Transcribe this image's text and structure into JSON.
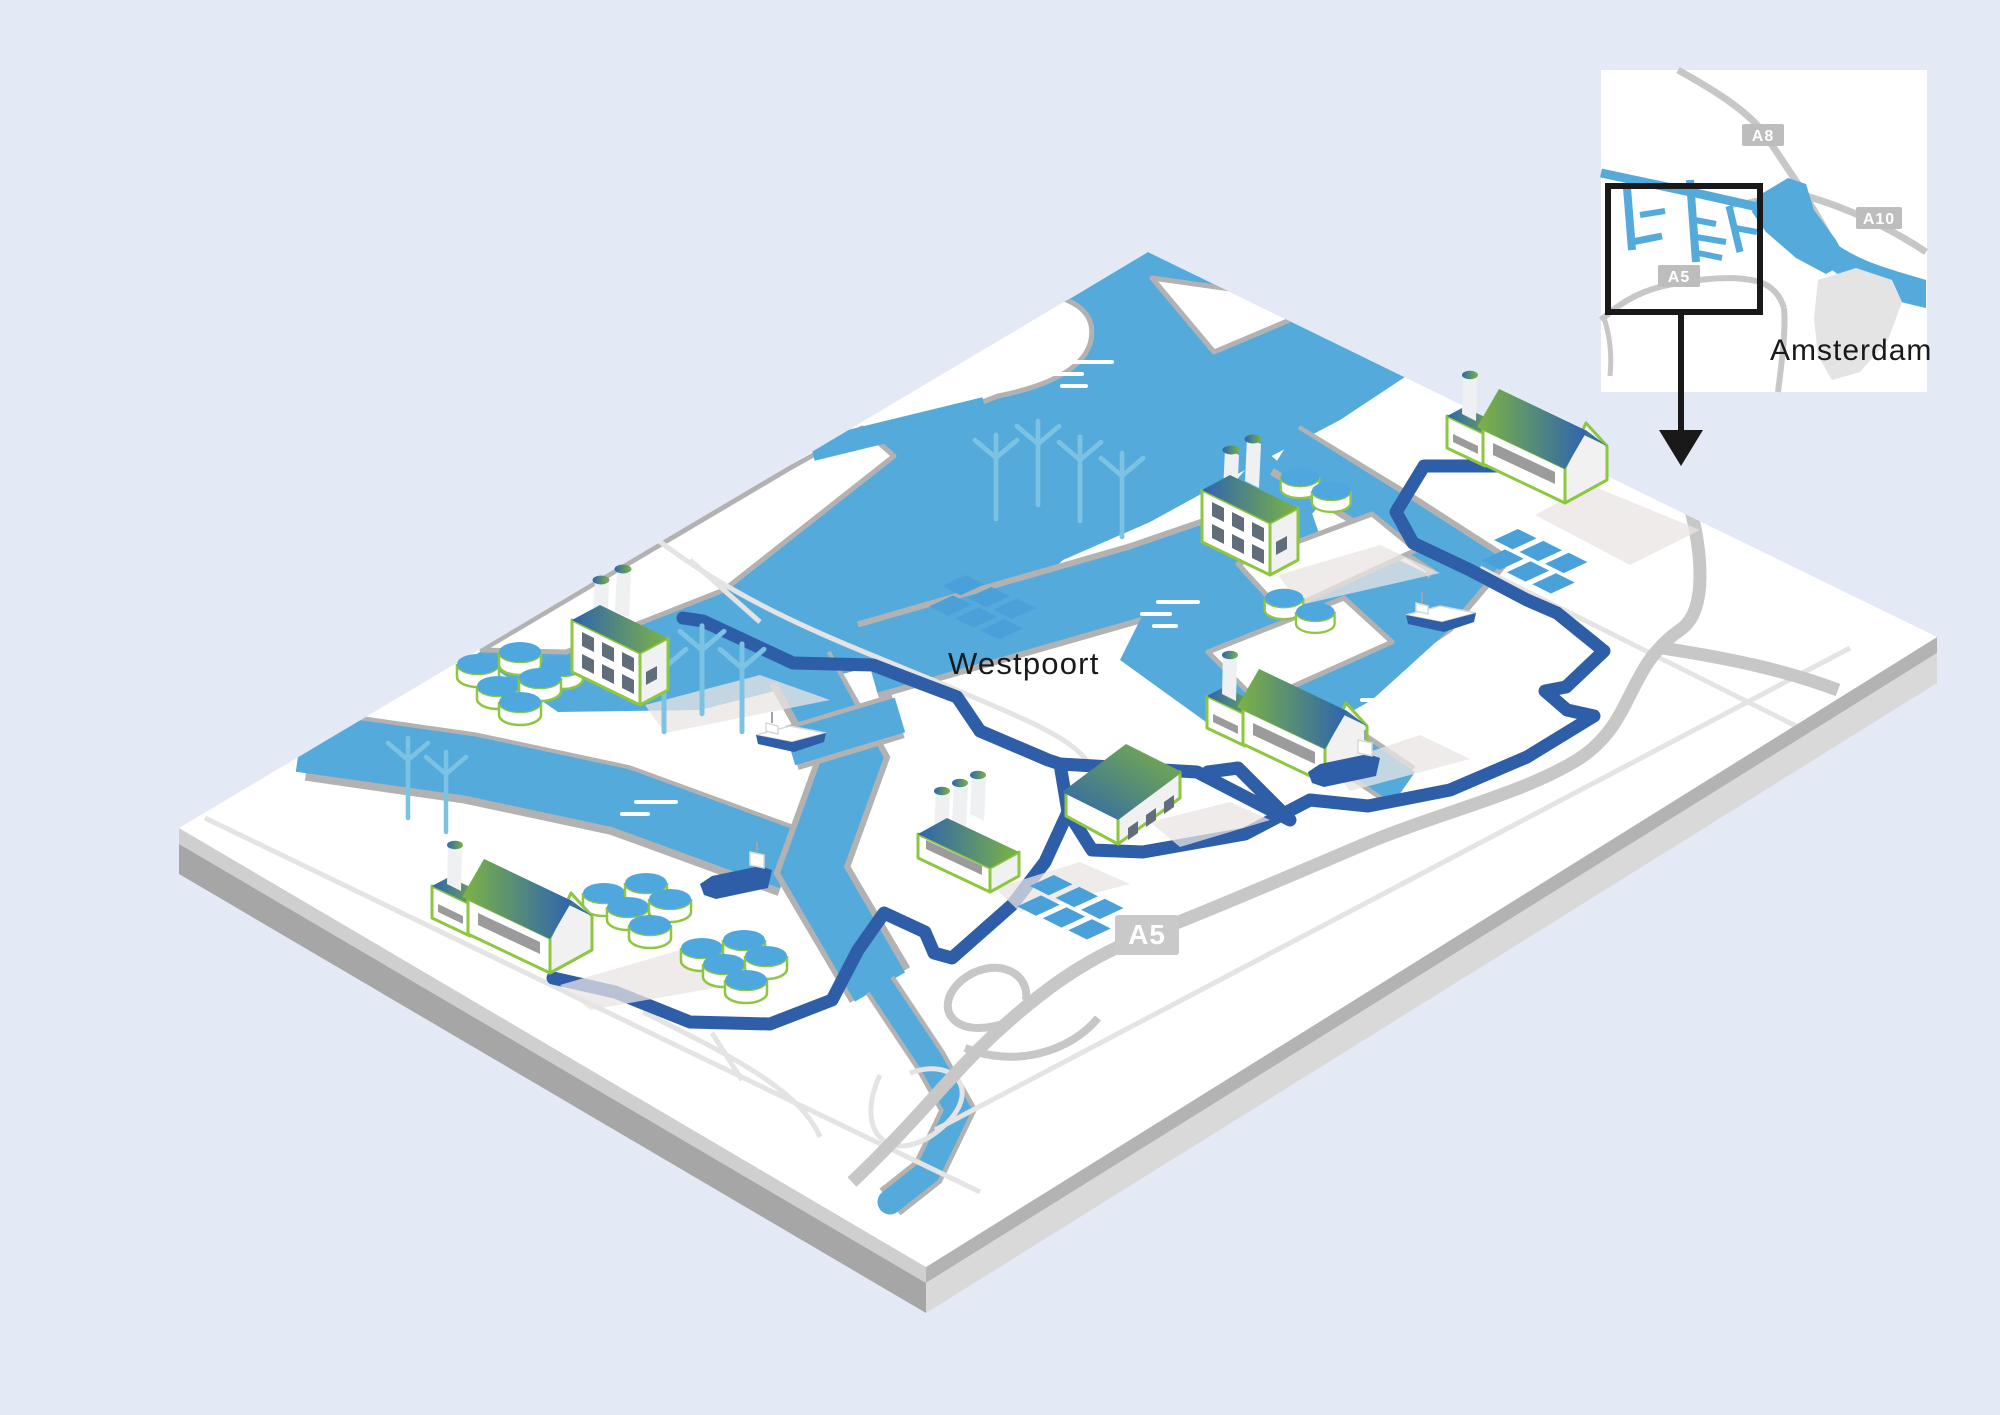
{
  "labels": {
    "area": "Westpoort",
    "city": "Amsterdam"
  },
  "badges": {
    "main_a5": "A5",
    "inset_a8": "A8",
    "inset_a10": "A10",
    "inset_a5": "A5"
  },
  "colors": {
    "bg": "#e3eaf5",
    "plate_top": "#ffffff",
    "side_r1": "#b3b3b3",
    "side_r2": "#d9d9d9",
    "side_l1": "#cfcfcf",
    "side_l2": "#a6a6a6",
    "water": "#55aadc",
    "quay": "#b2b2b2",
    "road_thin": "#e4e4e4",
    "road_major": "#c7c7c7",
    "route": "#2e5ea7",
    "turbine": "#7cc2e2",
    "tank": "#4ea8dd",
    "solar": "#4aa1d9",
    "green": "#8dc63f",
    "roof_blue": "#2e64ae",
    "roof_green": "#7db343",
    "wall": "#ffffff",
    "wall_side": "#f1f1f2",
    "window": "#5f6e7a",
    "door": "#9b9b9b",
    "ship": "#2e5ea7",
    "ink": "#191919",
    "shadow": "#e8e4e3",
    "badge": "#bdbdbd",
    "badge_main": "#c9c9c9",
    "city": "#e4e4e4"
  },
  "features": {
    "highways_shown": [
      "A5",
      "A8",
      "A10"
    ],
    "factories": 6,
    "houses": 1,
    "wind_turbines": 9,
    "storage_tanks": 20,
    "solar_panel_arrays": 3,
    "ships": 4,
    "icons": [
      "factory-icon",
      "house-icon",
      "wind-turbine-icon",
      "storage-tank-icon",
      "solar-panel-icon",
      "ship-icon",
      "pipeline-route",
      "inset-locator-arrow"
    ]
  }
}
